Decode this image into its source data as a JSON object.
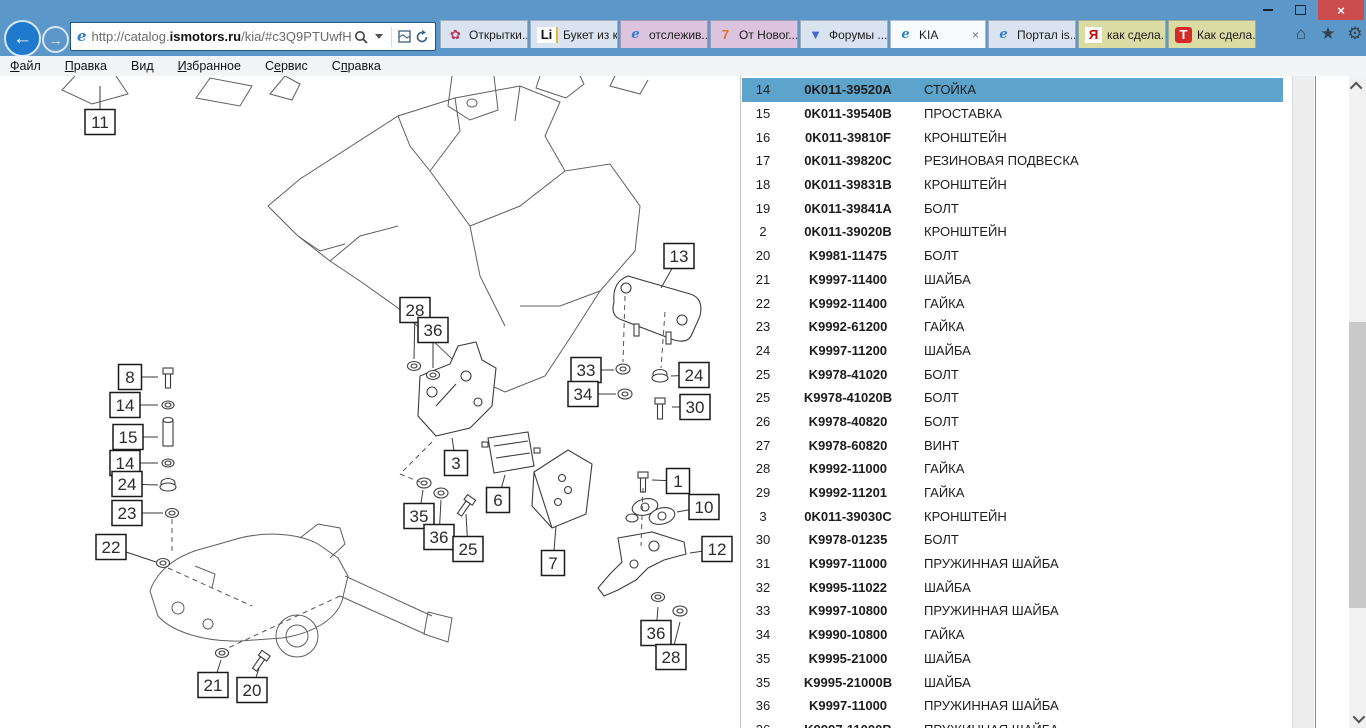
{
  "window": {
    "title_glyphs": {
      "minimize": "–",
      "restore": "❐",
      "close": "×"
    }
  },
  "browser": {
    "back_glyph": "←",
    "forward_glyph": "→",
    "url": {
      "pre": "http://catalog.",
      "host": "ismotors.ru",
      "path": "/kia/#c3Q9PTUwfHx5ZW"
    },
    "icon_glyphs": {
      "flower": "✿",
      "li": "Li",
      "ie": "e",
      "seven": "7",
      "forum": "▼",
      "yandex": "Я",
      "redt": "Т"
    },
    "cmd_icons": {
      "home": "⌂",
      "favorites": "★",
      "settings": "⚙"
    },
    "tabs": [
      {
        "label": "Открытки...",
        "icon": "flower",
        "group": "blue"
      },
      {
        "label": "Букет из к...",
        "icon": "li",
        "group": "blue"
      },
      {
        "label": "отслежив...",
        "icon": "ie",
        "group": "purple"
      },
      {
        "label": "От Новог...",
        "icon": "seven",
        "group": "purple"
      },
      {
        "label": "Форумы ...",
        "icon": "forum",
        "group": "blue"
      },
      {
        "label": "KIA",
        "icon": "ie",
        "group": "active",
        "active": true,
        "close": "×"
      },
      {
        "label": "Портал is...",
        "icon": "ie",
        "group": "blue"
      },
      {
        "label": "как сдела...",
        "icon": "yandex",
        "group": "khaki"
      },
      {
        "label": "Как сдела...",
        "icon": "redt",
        "group": "khaki"
      }
    ],
    "menu": [
      {
        "pre": "",
        "key": "Ф",
        "post": "айл"
      },
      {
        "pre": "",
        "key": "П",
        "post": "равка"
      },
      {
        "pre": "Ви",
        "key": "д",
        "post": ""
      },
      {
        "pre": "",
        "key": "И",
        "post": "збранное"
      },
      {
        "pre": "С",
        "key": "е",
        "post": "рвис"
      },
      {
        "pre": "С",
        "key": "п",
        "post": "равка"
      }
    ]
  },
  "table": {
    "rows": [
      {
        "num": "14",
        "part": "0K011-39520A",
        "name": "СТОЙКА",
        "hl": true
      },
      {
        "num": "15",
        "part": "0K011-39540B",
        "name": "ПРОСТАВКА"
      },
      {
        "num": "16",
        "part": "0K011-39810F",
        "name": "КРОНШТЕЙН"
      },
      {
        "num": "17",
        "part": "0K011-39820C",
        "name": "РЕЗИНОВАЯ ПОДВЕСКА"
      },
      {
        "num": "18",
        "part": "0K011-39831B",
        "name": "КРОНШТЕЙН"
      },
      {
        "num": "19",
        "part": "0K011-39841A",
        "name": "БОЛТ"
      },
      {
        "num": "2",
        "part": "0K011-39020B",
        "name": "КРОНШТЕЙН"
      },
      {
        "num": "20",
        "part": "K9981-11475",
        "name": "БОЛТ"
      },
      {
        "num": "21",
        "part": "K9997-11400",
        "name": "ШАЙБА"
      },
      {
        "num": "22",
        "part": "K9992-11400",
        "name": "ГАЙКА"
      },
      {
        "num": "23",
        "part": "K9992-61200",
        "name": "ГАЙКА"
      },
      {
        "num": "24",
        "part": "K9997-11200",
        "name": "ШАЙБА"
      },
      {
        "num": "25",
        "part": "K9978-41020",
        "name": "БОЛТ"
      },
      {
        "num": "25",
        "part": "K9978-41020B",
        "name": "БОЛТ"
      },
      {
        "num": "26",
        "part": "K9978-40820",
        "name": "БОЛТ"
      },
      {
        "num": "27",
        "part": "K9978-60820",
        "name": "ВИНТ"
      },
      {
        "num": "28",
        "part": "K9992-11000",
        "name": "ГАЙКА"
      },
      {
        "num": "29",
        "part": "K9992-11201",
        "name": "ГАЙКА"
      },
      {
        "num": "3",
        "part": "0K011-39030C",
        "name": "КРОНШТЕЙН"
      },
      {
        "num": "30",
        "part": "K9978-01235",
        "name": "БОЛТ"
      },
      {
        "num": "31",
        "part": "K9997-11000",
        "name": "ПРУЖИННАЯ ШАЙБА"
      },
      {
        "num": "32",
        "part": "K9995-11022",
        "name": "ШАЙБА"
      },
      {
        "num": "33",
        "part": "K9997-10800",
        "name": "ПРУЖИННАЯ ШАЙБА"
      },
      {
        "num": "34",
        "part": "K9990-10800",
        "name": "ГАЙКА"
      },
      {
        "num": "35",
        "part": "K9995-21000",
        "name": "ШАЙБА"
      },
      {
        "num": "35",
        "part": "K9995-21000B",
        "name": "ШАЙБА"
      },
      {
        "num": "36",
        "part": "K9997-11000",
        "name": "ПРУЖИННАЯ ШАЙБА"
      },
      {
        "num": "36",
        "part": "K9997-11000B",
        "name": "ПРУЖИННАЯ ШАЙБА"
      }
    ]
  },
  "diagram": {
    "callouts": [
      {
        "label": "11",
        "x": 100,
        "y": 46,
        "lx": 100,
        "ly": 10
      },
      {
        "label": "8",
        "x": 130,
        "y": 301,
        "lx": 158,
        "ly": 301
      },
      {
        "label": "14",
        "x": 125,
        "y": 329,
        "lx": 158,
        "ly": 329
      },
      {
        "label": "15",
        "x": 128,
        "y": 361,
        "lx": 158,
        "ly": 361
      },
      {
        "label": "14",
        "x": 125,
        "y": 387,
        "lx": 158,
        "ly": 387
      },
      {
        "label": "24",
        "x": 127,
        "y": 408,
        "lx": 158,
        "ly": 409
      },
      {
        "label": "23",
        "x": 127,
        "y": 437,
        "lx": 163,
        "ly": 437
      },
      {
        "label": "22",
        "x": 111,
        "y": 471,
        "lx": 156,
        "ly": 486
      },
      {
        "label": "21",
        "x": 213,
        "y": 609,
        "lx": 221,
        "ly": 584
      },
      {
        "label": "20",
        "x": 252,
        "y": 614,
        "lx": 259,
        "ly": 592
      },
      {
        "label": "28",
        "x": 415,
        "y": 234,
        "lx": 414,
        "ly": 283
      },
      {
        "label": "36",
        "x": 433,
        "y": 254,
        "lx": 433,
        "ly": 292
      },
      {
        "label": "3",
        "x": 456,
        "y": 387,
        "lx": 452,
        "ly": 362
      },
      {
        "label": "35",
        "x": 419,
        "y": 440,
        "lx": 423,
        "ly": 414
      },
      {
        "label": "36",
        "x": 439,
        "y": 461,
        "lx": 441,
        "ly": 424
      },
      {
        "label": "25",
        "x": 468,
        "y": 473,
        "lx": 466,
        "ly": 438
      },
      {
        "label": "6",
        "x": 498,
        "y": 424,
        "lx": 505,
        "ly": 399
      },
      {
        "label": "7",
        "x": 553,
        "y": 487,
        "lx": 556,
        "ly": 450
      },
      {
        "label": "13",
        "x": 679,
        "y": 180,
        "lx": 661,
        "ly": 212
      },
      {
        "label": "33",
        "x": 586,
        "y": 294,
        "lx": 614,
        "ly": 294
      },
      {
        "label": "34",
        "x": 583,
        "y": 318,
        "lx": 616,
        "ly": 318
      },
      {
        "label": "24",
        "x": 694,
        "y": 299,
        "lx": 671,
        "ly": 300
      },
      {
        "label": "30",
        "x": 695,
        "y": 331,
        "lx": 672,
        "ly": 331
      },
      {
        "label": "1",
        "x": 678,
        "y": 405,
        "lx": 652,
        "ly": 404
      },
      {
        "label": "10",
        "x": 704,
        "y": 431,
        "lx": 677,
        "ly": 436
      },
      {
        "label": "12",
        "x": 717,
        "y": 473,
        "lx": 690,
        "ly": 477
      },
      {
        "label": "36",
        "x": 656,
        "y": 557,
        "lx": 658,
        "ly": 531
      },
      {
        "label": "28",
        "x": 671,
        "y": 581,
        "lx": 680,
        "ly": 546
      }
    ]
  }
}
